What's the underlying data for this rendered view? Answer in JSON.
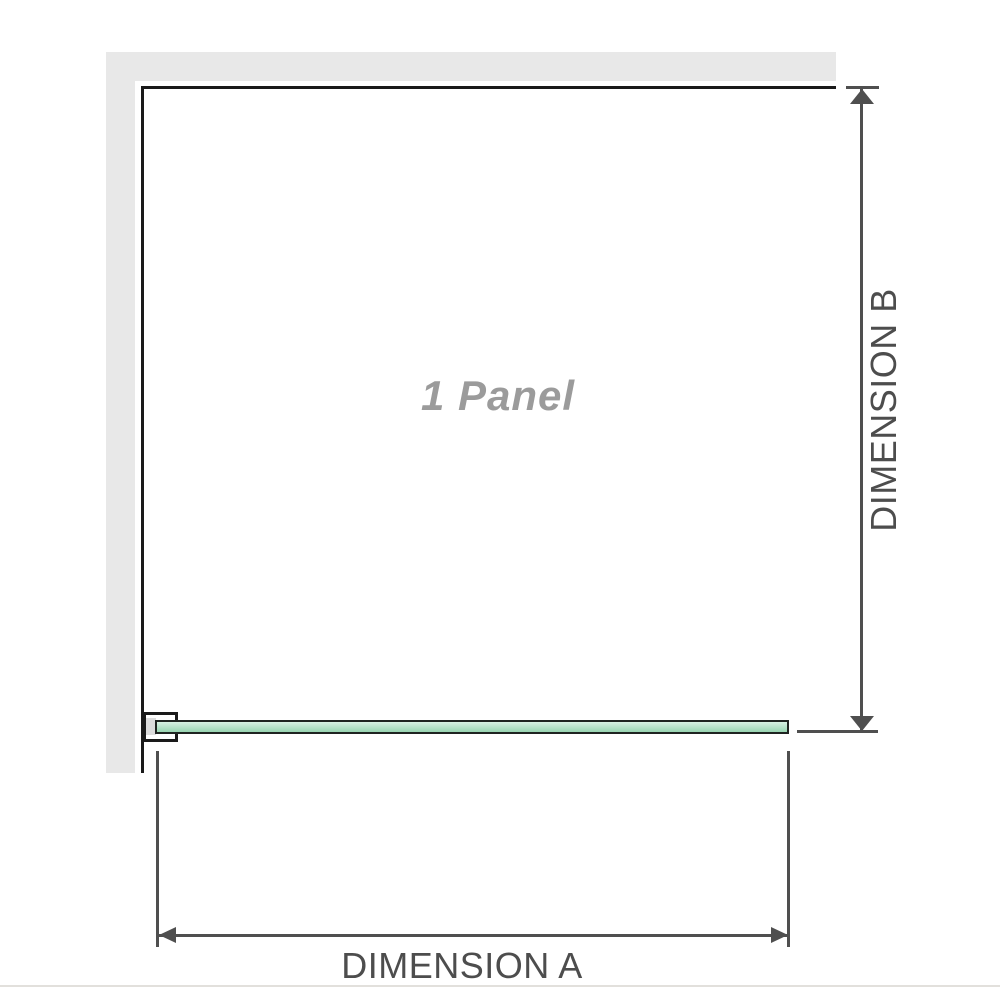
{
  "diagram": {
    "panel_label": "1 Panel",
    "dimension_a_label": "DIMENSION A",
    "dimension_b_label": "DIMENSION B"
  },
  "colors": {
    "wall": "#e8e8e8",
    "outline": "#1a1a1a",
    "panel_label": "#9b9b9b",
    "bracket_pad": "#dcdcdc",
    "glass_border": "#1f2421",
    "glass_light": "#d8f1e4",
    "glass_dark": "#98d5b2",
    "dimension_line": "#4f4f4f",
    "dimension_text": "#4d4d4d",
    "baseline": "#e2e0dc"
  }
}
